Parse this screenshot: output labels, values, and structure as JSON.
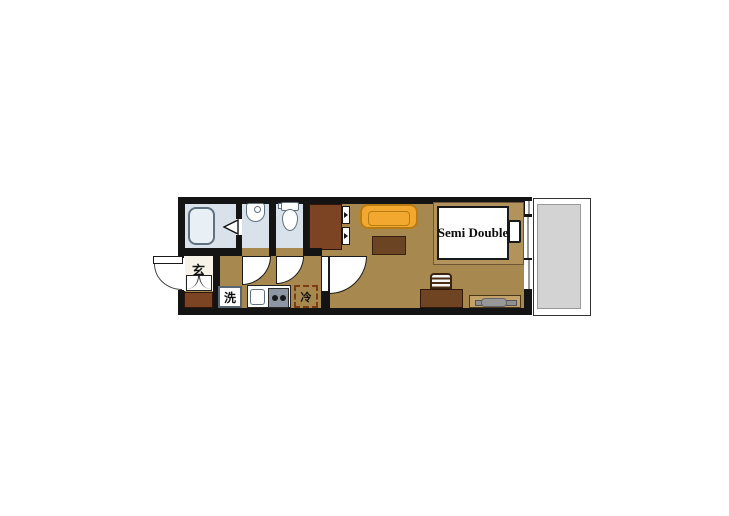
{
  "floorplan": {
    "labels": {
      "entrance": "玄",
      "washing_machine": "洗",
      "refrigerator": "冷",
      "bed_size": "Semi Double"
    },
    "colors": {
      "wall": "#141414",
      "floor": "#a7894f",
      "wet_room": "#d9e2ea",
      "closet": "#7c4423",
      "entrance_floor": "#f7f3e8",
      "sofa": "#f2a72e",
      "low_table": "#6b4423",
      "bed_frame": "#b2935c",
      "desk": "#6e4423",
      "tv_board": "#c2a268",
      "tv": "#8f8f8f",
      "balcony_floor": "#d3d3d3",
      "refrigerator_outline": "#7a3d16"
    }
  }
}
